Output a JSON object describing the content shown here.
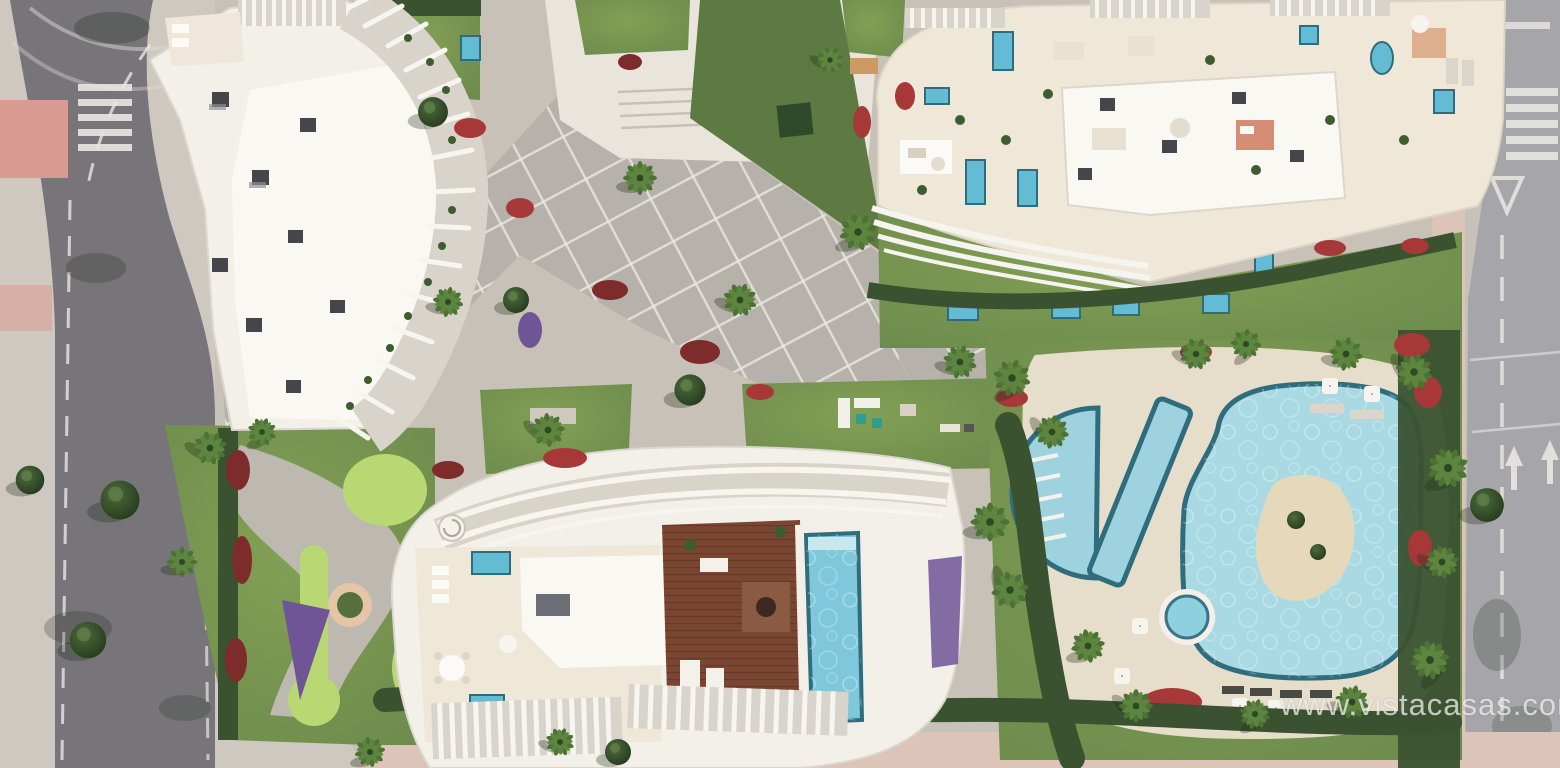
{
  "watermark": {
    "text": "www.vistacasas.com"
  },
  "palette": {
    "base": "#cbc4bb",
    "asphalt_dark": "#77757a",
    "asphalt_light": "#a6a5a9",
    "sidewalk": "#cfc8c0",
    "sidewalk_pink": "#dcc4b9",
    "road_paint_pink": "#d99a92",
    "road_mark_white": "#e9e7e3",
    "building_white": "#f3f0ea",
    "roof_bright": "#faf8f3",
    "terrace_beige": "#efe7d8",
    "terrace_gray": "#d9d4cb",
    "paving": "#b6b1aa",
    "paving_line": "#e9e6e0",
    "lawn": "#79974e",
    "lawn_dark": "#5d7a42",
    "golf_green": "#b9d873",
    "golf_sand": "#e5c5a8",
    "hedge": "#3a5230",
    "tree_dark": "#2c4526",
    "palm": "#4d7234",
    "flower_red": "#a63838",
    "flower_crimson": "#7e2b2b",
    "flower_purple": "#6f5596",
    "pool_lagoon": "#a9dae3",
    "pool_rim": "#2f6d7e",
    "pool_plunge": "#64bcd4",
    "pool_steps": "#c7e9ee",
    "deck_wood": "#7a4632",
    "deck_plank": "#5f3626",
    "island_sand": "#e6d8ba",
    "shadow": "#1e2b18",
    "watermark_color": "#ecebe9"
  },
  "legend": {
    "palm_tree_glyph": "radial-frond-cluster",
    "round_tree_glyph": "circle-canopy",
    "umbrella_glyph": "white-square",
    "lounger_glyph": "small-rect"
  }
}
